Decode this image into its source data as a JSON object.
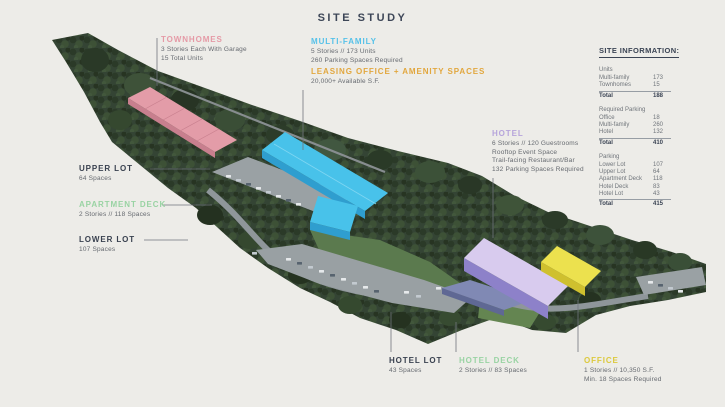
{
  "title": "SITE STUDY",
  "colors": {
    "townhomes": "#e59aa6",
    "multi_family": "#55c1e9",
    "leasing": "#e2a73e",
    "hotel": "#b6a4db",
    "decks": "#99d3a3",
    "office": "#dcc93c",
    "lots": "#39414f",
    "background": "#edece8"
  },
  "callouts": [
    {
      "id": "townhomes",
      "label": "TOWNHOMES",
      "lines": [
        "3 Stories Each With Garage",
        "15 Total Units"
      ]
    },
    {
      "id": "multi-family",
      "label": "MULTI-FAMILY",
      "lines": [
        "5 Stories // 173 Units",
        "260 Parking Spaces Required"
      ]
    },
    {
      "id": "leasing-office",
      "label": "LEASING OFFICE + AMENITY SPACES",
      "lines": [
        "20,000+ Available S.F."
      ]
    },
    {
      "id": "hotel",
      "label": "HOTEL",
      "lines": [
        "6 Stories // 120 Guestrooms",
        "Rooftop Event Space",
        "Trail-facing Restaurant/Bar",
        "132 Parking Spaces Required"
      ]
    },
    {
      "id": "upper-lot",
      "label": "UPPER LOT",
      "lines": [
        "64 Spaces"
      ]
    },
    {
      "id": "apartment-deck",
      "label": "APARTMENT DECK",
      "lines": [
        "2 Stories // 118 Spaces"
      ]
    },
    {
      "id": "lower-lot",
      "label": "LOWER LOT",
      "lines": [
        "107 Spaces"
      ]
    },
    {
      "id": "hotel-lot",
      "label": "HOTEL LOT",
      "lines": [
        "43 Spaces"
      ]
    },
    {
      "id": "hotel-deck",
      "label": "HOTEL DECK",
      "lines": [
        "2 Stories // 83 Spaces"
      ]
    },
    {
      "id": "office",
      "label": "OFFICE",
      "lines": [
        "1 Stories // 10,350 S.F.",
        "Min. 18 Spaces Required"
      ]
    }
  ],
  "site_information": {
    "heading": "SITE INFORMATION:",
    "sections": [
      {
        "heading": "Units",
        "rows": [
          [
            "Multi-family",
            "173"
          ],
          [
            "Townhomes",
            "15"
          ]
        ],
        "total": [
          "Total",
          "188"
        ]
      },
      {
        "heading": "Required Parking",
        "rows": [
          [
            "Office",
            "18"
          ],
          [
            "Multi-family",
            "260"
          ],
          [
            "Hotel",
            "132"
          ]
        ],
        "total": [
          "Total",
          "410"
        ]
      },
      {
        "heading": "Parking",
        "rows": [
          [
            "Lower Lot",
            "107"
          ],
          [
            "Upper Lot",
            "64"
          ],
          [
            "Apartment Deck",
            "118"
          ],
          [
            "Hotel Deck",
            "83"
          ],
          [
            "Hotel Lot",
            "43"
          ]
        ],
        "total": [
          "Total",
          "415"
        ]
      }
    ]
  }
}
